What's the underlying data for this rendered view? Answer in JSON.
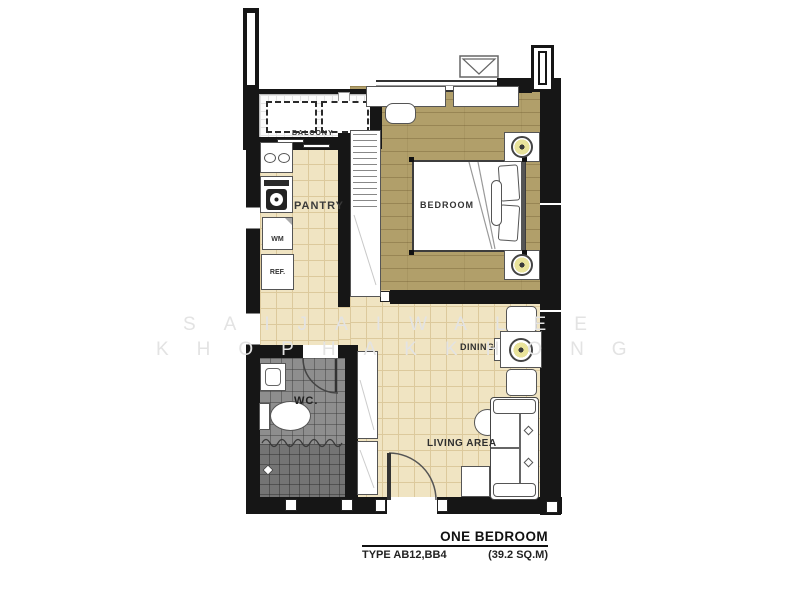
{
  "plan": {
    "rooms": {
      "balcony": "BALCONY",
      "pantry": "PANTRY",
      "bedroom": "BEDROOM",
      "wc": "WC.",
      "dining": "DINING",
      "living": "LIVING AREA"
    },
    "appliances": {
      "washing_machine": "WM",
      "refrigerator": "REF."
    }
  },
  "caption": {
    "title": "ONE BEDROOM",
    "type": "TYPE AB12,BB4",
    "area": "(39.2 SQ.M)"
  },
  "watermark": {
    "line1": "SAIJAIWALEE",
    "line2": "KHOPHAKKHONG"
  },
  "colors": {
    "wall": "#161616",
    "wood": "#b19f6a",
    "tile": "#f0e4c2",
    "tile_line": "#dcc99c",
    "wc_floor": "#8e8e8e",
    "shower_floor": "#747474",
    "lamp": "#e9e39b",
    "watermark": "#e3e3e3"
  }
}
